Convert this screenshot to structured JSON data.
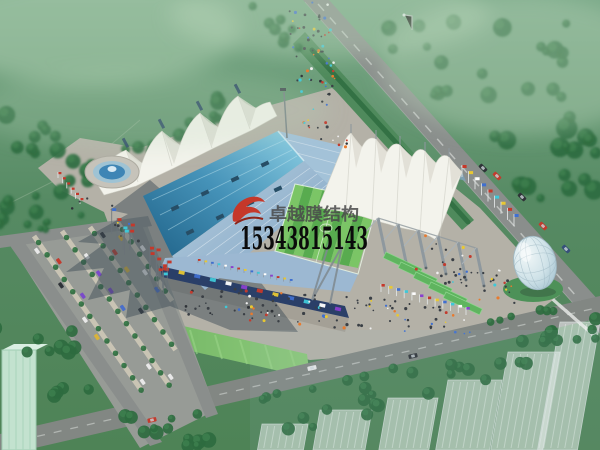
{
  "watermark": {
    "brand": "卓越膜结构",
    "phone": "15343815143",
    "brand_color": "#49494a",
    "phone_color": "#0b0b0b",
    "logo_color": "#c5382a"
  },
  "scene": {
    "palette": {
      "field": "#568a63",
      "field_top": "#7aa988",
      "forest": "#2e6b3f",
      "forest_light": "#3f8250",
      "road": "#8a8e8c",
      "road_line": "#d8dcd8",
      "plaza": "#b4b1a7",
      "plaza_shade": "#a09c92",
      "shadow": "#3d4b55",
      "roof_blue": "#2e7aa0",
      "roof_blue_light": "#8ed0e4",
      "seats": "#a3c2d8",
      "membrane": "#f3f3ec",
      "membrane_shade": "#d9d9d0",
      "pitch": "#58ab4f",
      "pitch_light": "#7bc566",
      "lawn": "#74b765",
      "canopy_green": "#5fb45f",
      "facade": "#2a3f68",
      "glass_dome": "#cfe2e8",
      "water": "#3e85b5",
      "mast_grey": "#8e989e",
      "flag_colors": [
        "#c5382a",
        "#e8c832",
        "#3f6fd0",
        "#3ec8d8",
        "#ffffff",
        "#8a3fd0"
      ],
      "car_colors": [
        "#c23b2e",
        "#d9b33a",
        "#4a6fc9",
        "#7a4ac9",
        "#e8e8e8",
        "#2f3338"
      ],
      "crowd_colors": [
        "#c23b2e",
        "#3f6fd0",
        "#e8c832",
        "#3ec8d8",
        "#f0f0f0",
        "#2f3338",
        "#e87a2e"
      ]
    }
  }
}
